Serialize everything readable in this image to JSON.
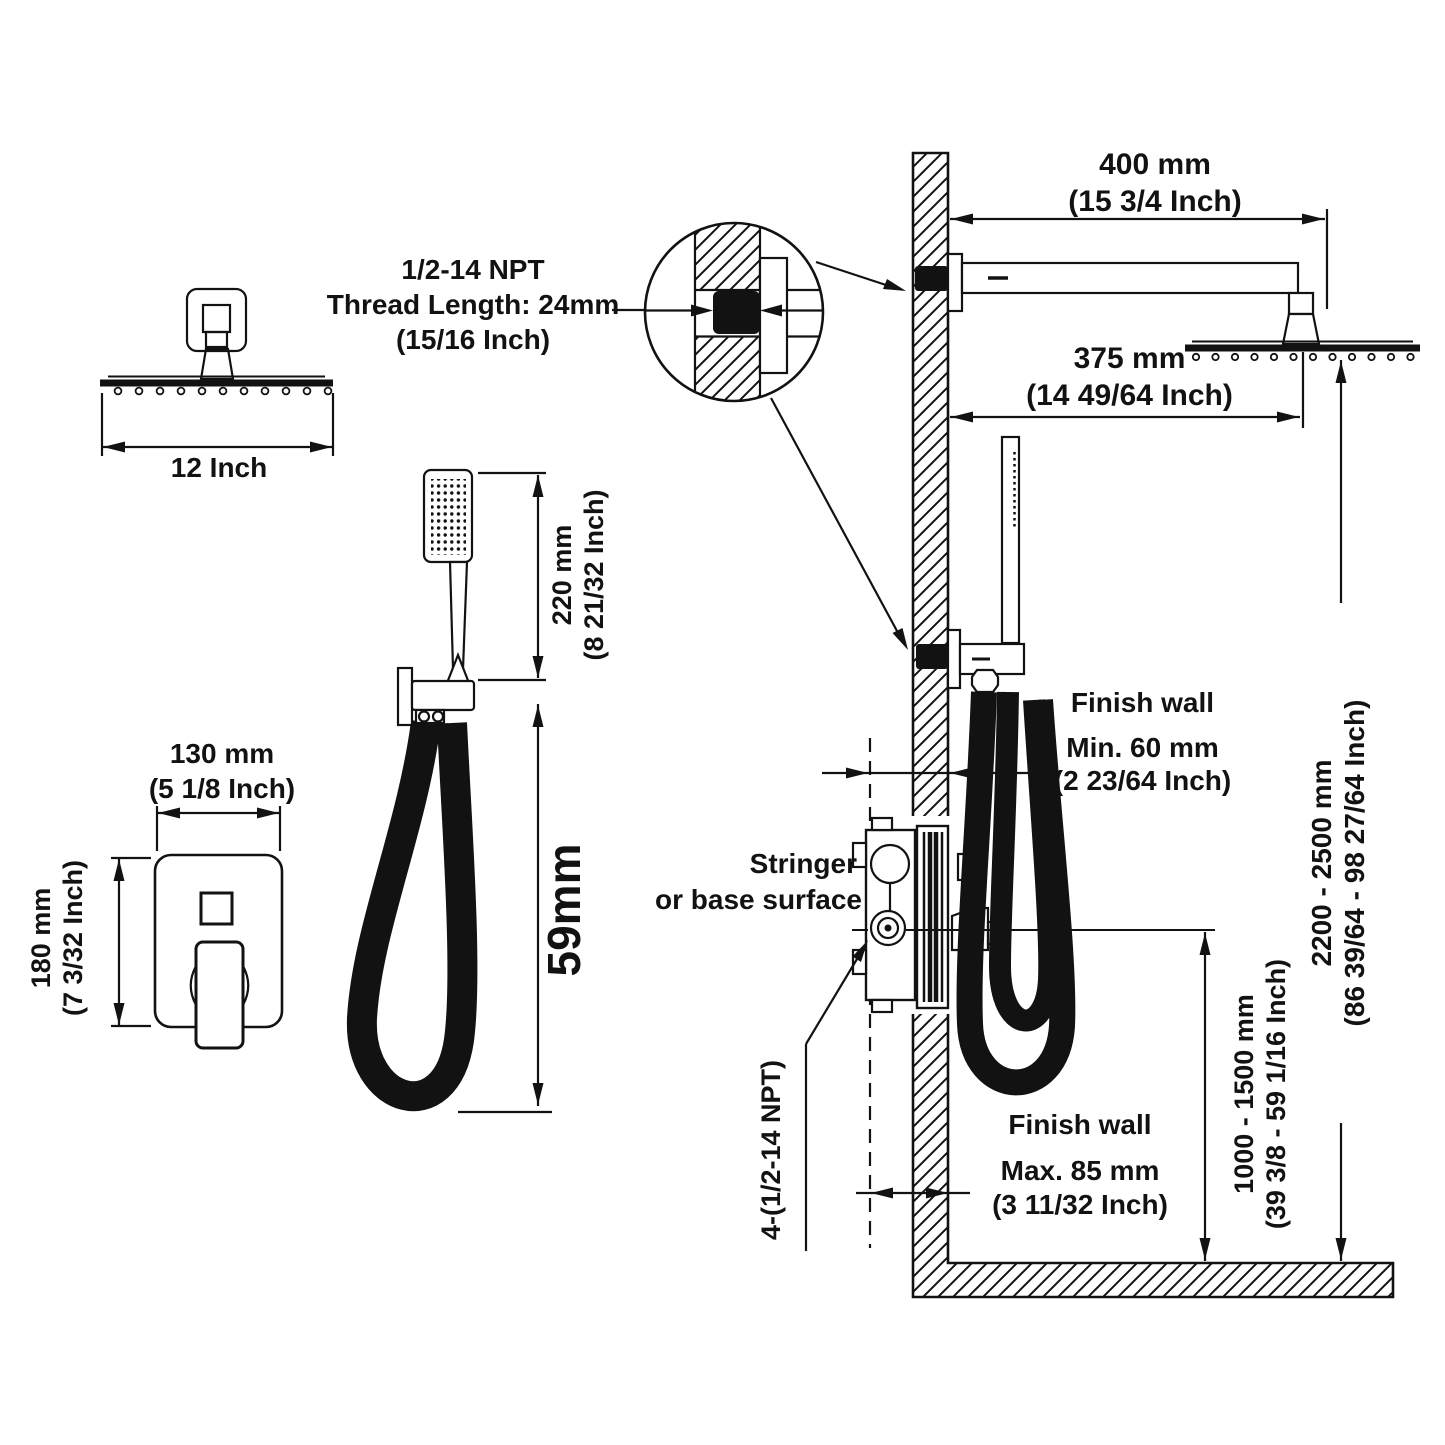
{
  "diagram": {
    "head_top": {
      "width_label": "12 Inch"
    },
    "thread_note": {
      "line1": "1/2-14 NPT",
      "line2": "Thread Length: 24mm",
      "line3": "(15/16 Inch)"
    },
    "arm_length": {
      "mm": "400 mm",
      "inch": "(15 3/4 Inch)"
    },
    "head_offset": {
      "mm": "375 mm",
      "inch": "(14 49/64 Inch)"
    },
    "handshower_length": {
      "mm": "220 mm",
      "inch": "(8 21/32 Inch)"
    },
    "hose_drop": {
      "label": "59mm"
    },
    "valve_width": {
      "mm": "130 mm",
      "inch": "(5 1/8 Inch)"
    },
    "valve_height": {
      "mm": "180 mm",
      "inch": "(7 3/32 Inch)"
    },
    "min_depth": {
      "title": "Finish wall",
      "mm": "Min. 60 mm",
      "inch": "(2 23/64 Inch)"
    },
    "stringer": {
      "line1": "Stringer",
      "line2": "or base surface"
    },
    "max_depth": {
      "title": "Finish wall",
      "mm": "Max. 85 mm",
      "inch": "(3 11/32 Inch)"
    },
    "ports": {
      "label": "4-(1/2-14 NPT)"
    },
    "valve_mount_height": {
      "mm": "1000 - 1500 mm",
      "inch": "(39 3/8 - 59 1/16 Inch)"
    },
    "head_mount_height": {
      "mm": "2200 - 2500 mm",
      "inch": "(86 39/64 - 98 27/64 Inch)"
    },
    "colors": {
      "ink": "#121212",
      "paper": "#ffffff"
    }
  }
}
